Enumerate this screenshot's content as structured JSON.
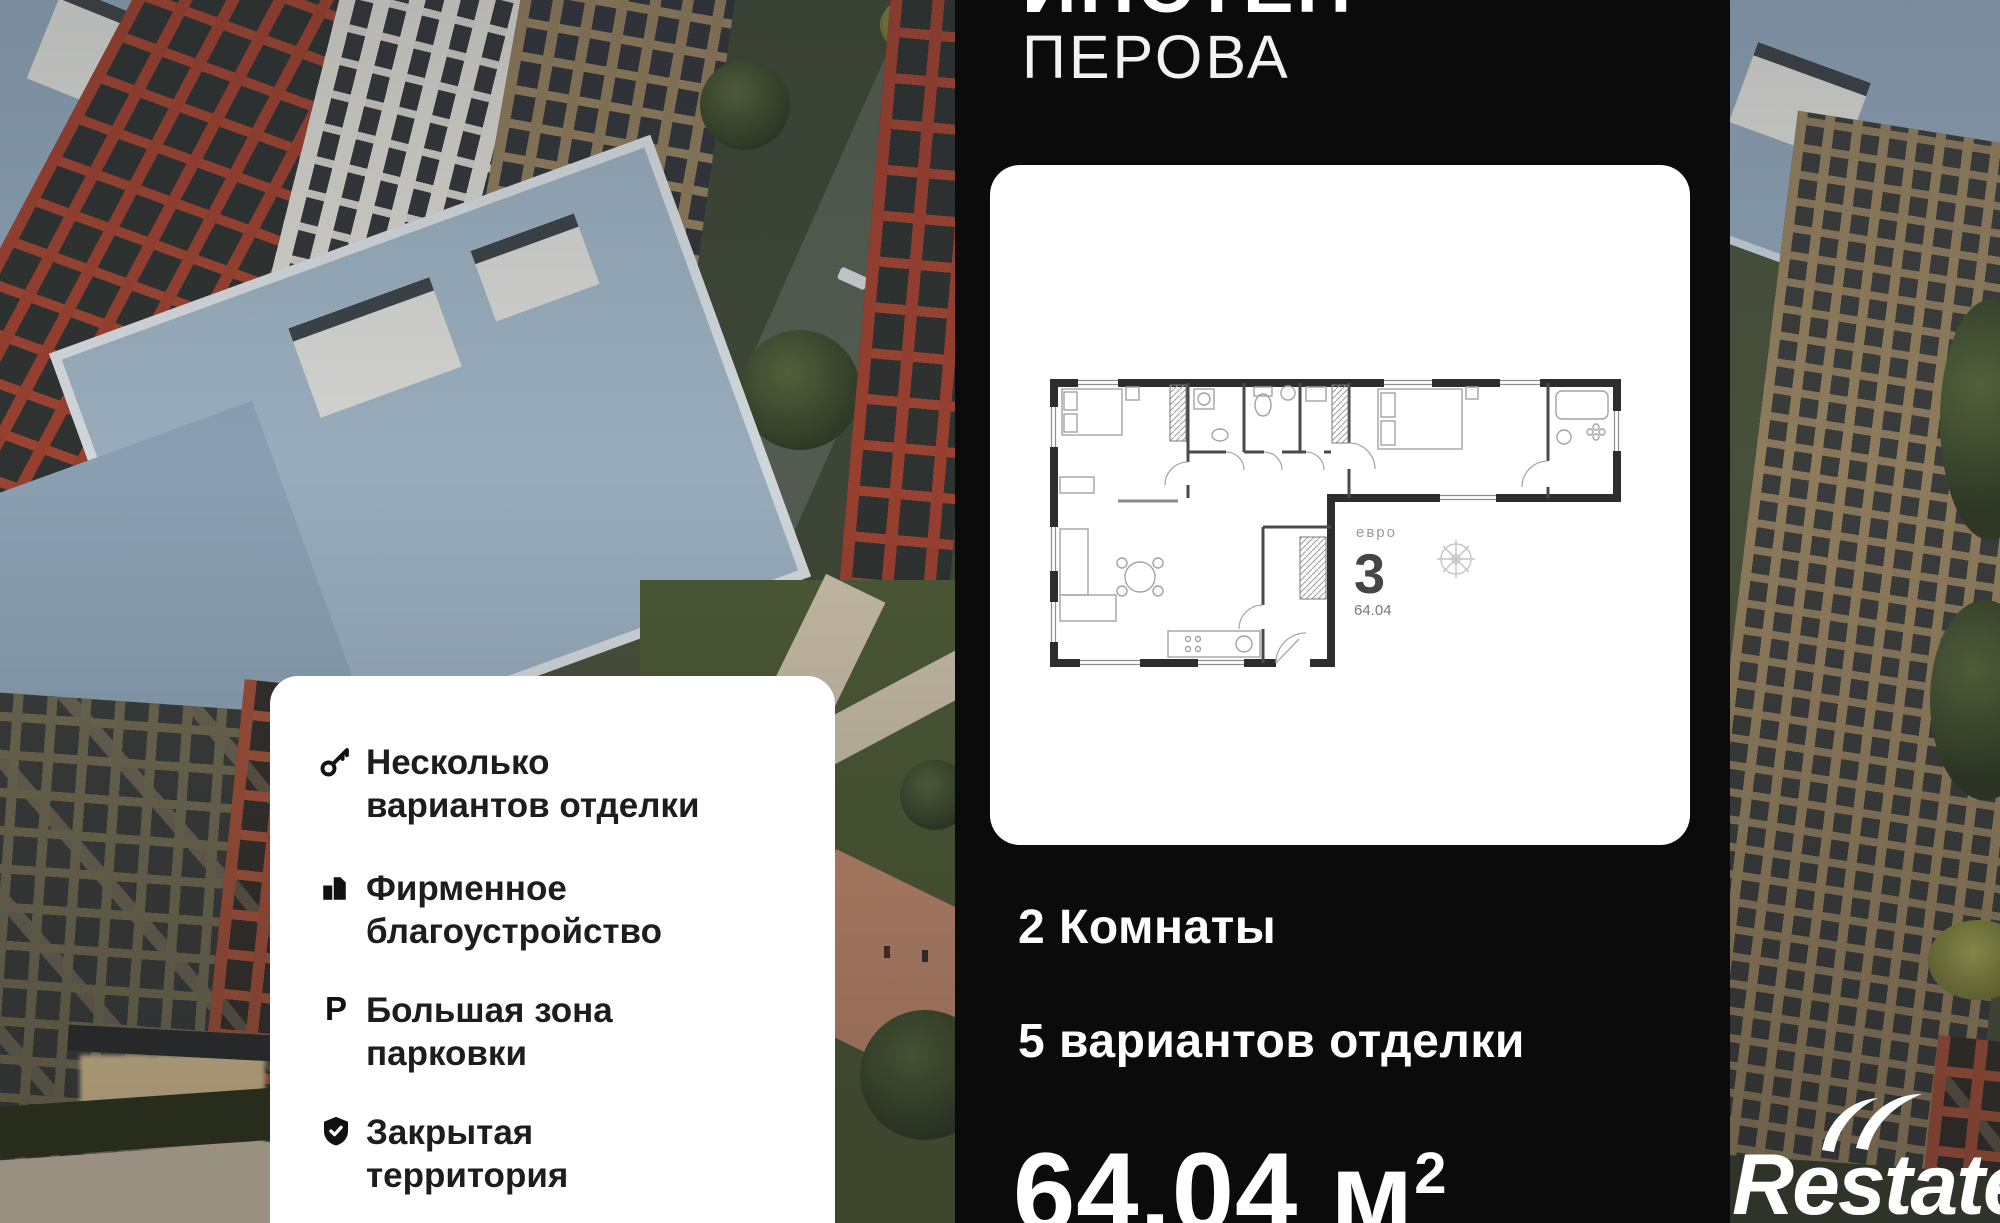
{
  "panel": {
    "title_line1": "ИНСТЕП",
    "title_line2": "ПЕРОВА",
    "rooms": "2 Комнаты",
    "finishes": "5 вариантов отделки",
    "area_value": "64.04",
    "area_unit": " м",
    "area_sup": "2"
  },
  "floorplan": {
    "type_label_top": "евро",
    "type_number": "3",
    "area_small": "64.04"
  },
  "features": {
    "items": [
      {
        "icon": "key-icon",
        "line1": "Несколько",
        "line2": "вариантов отделки"
      },
      {
        "icon": "building-icon",
        "line1": "Фирменное",
        "line2": "благоустройство"
      },
      {
        "icon": "parking-icon",
        "letter": "P",
        "line1": "Большая зона",
        "line2": "парковки"
      },
      {
        "icon": "shield-check-icon",
        "line1": "Закрытая",
        "line2": "территория"
      }
    ]
  },
  "logo": {
    "text": "Restate"
  },
  "colors": {
    "panel_bg": "#0b0b0c",
    "card_bg": "#ffffff",
    "text_dark": "#1d1d1f",
    "text_light": "#ffffff",
    "roof_blue": "#8ea3b6",
    "brick_red": "#9c4130",
    "facade_tan": "#93805f"
  }
}
